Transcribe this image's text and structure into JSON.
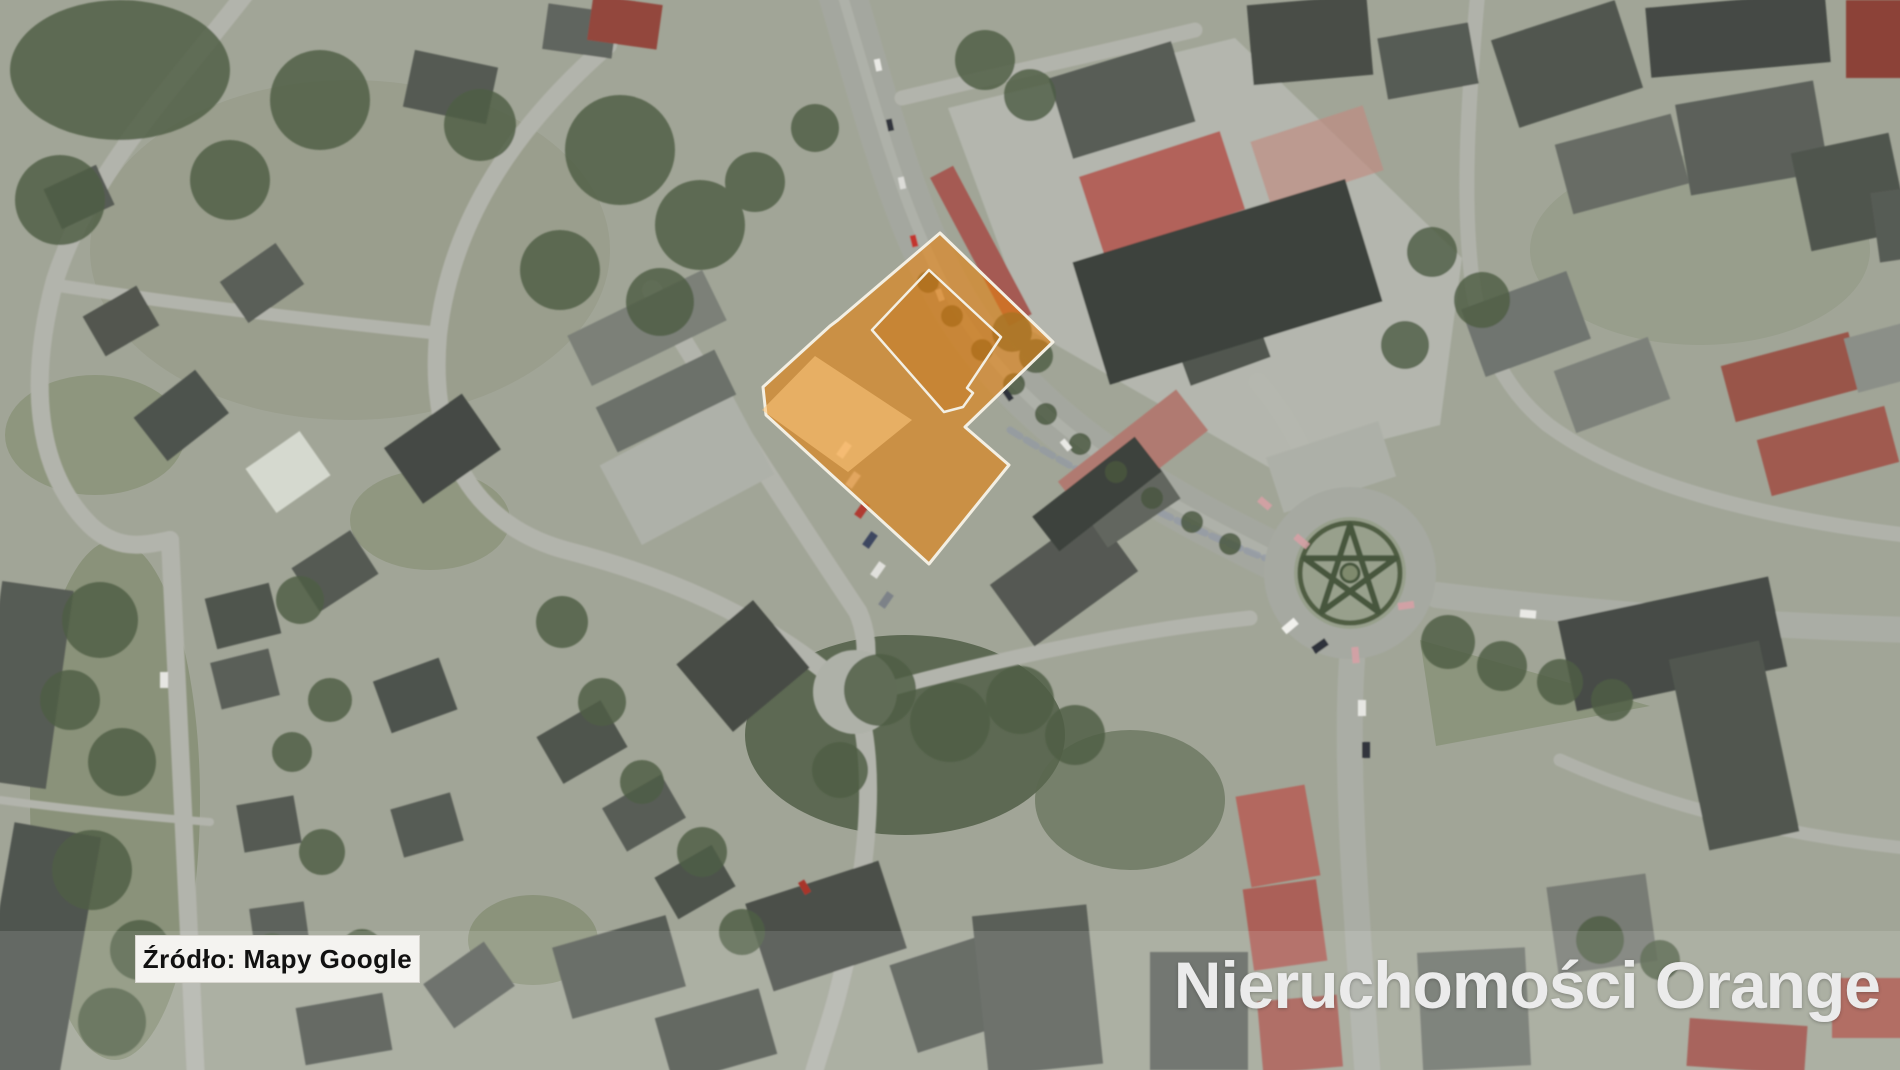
{
  "map": {
    "type": "satellite-aerial-photo",
    "source_label": "Źródło: Mapy Google",
    "watermark": "Nieruchomości Orange"
  },
  "highlight": {
    "fill": "#e8820a",
    "outline": "#f3efe3",
    "parcel_outline_points": "940,233 838,320 830,326 763,387 766,415 929,564 1009,465 965,427 1053,342",
    "building_main_points": "929,270 1001,337 967,388 973,393 963,407 944,412 872,330",
    "building_secondary_points": "815,356 912,420 848,472 762,410",
    "building_main_fill": "#c06d12",
    "building_secondary_fill": "#ffc87d"
  }
}
